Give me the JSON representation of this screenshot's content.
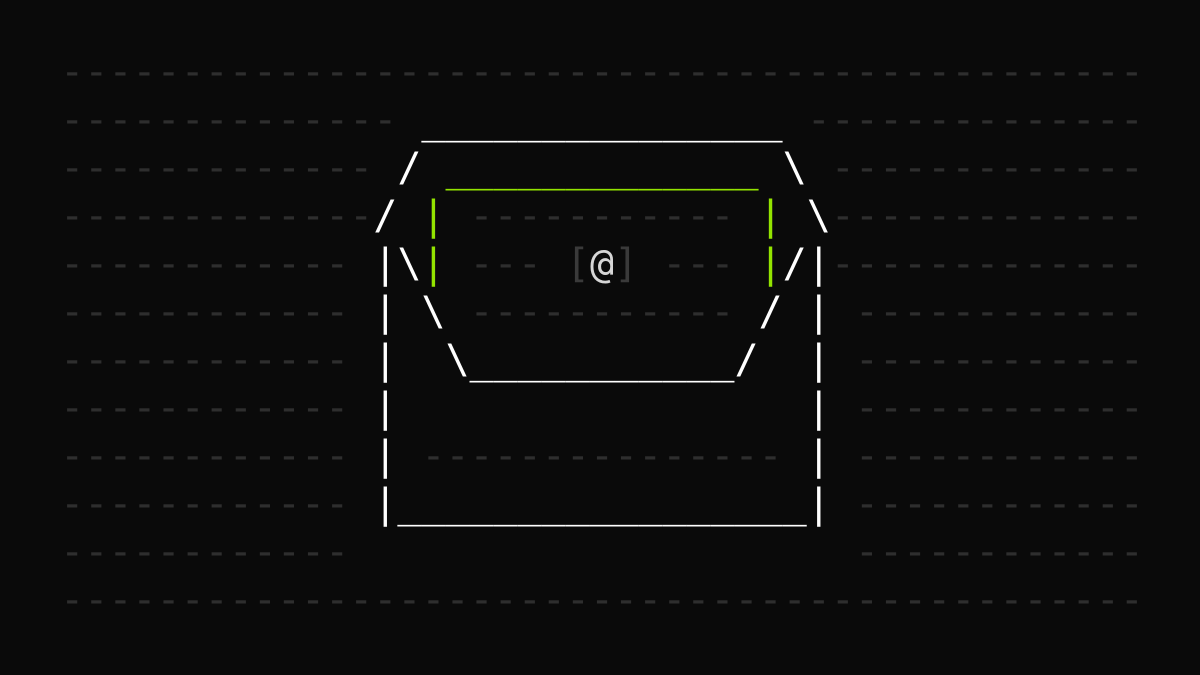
{
  "canvas": {
    "width_px": 1200,
    "height_px": 675,
    "background_color": "#0a0a0a"
  },
  "colors": {
    "background_dash_gray": "#2e2e2e",
    "envelope_white": "#ffffff",
    "letter_green": "#93e400",
    "bracket_gray": "#3a3a3a",
    "at_symbol_light": "#d6d6d6"
  },
  "ascii_art": {
    "background_dashes": [
      "",
      "  ---------------------------------------------",
      "  --------------                 --------------",
      "  -------------                   -------------",
      "  -------------    -----------    -------------",
      "  ------------     ---     ---    -------------",
      "  ------------     -----------     ------------",
      "  ------------                     ------------",
      "  ------------                     ------------",
      "  ------------   ---------------   ------------",
      "  ------------                     ------------",
      "  ------------                     ------------",
      "  ---------------------------------------------",
      ""
    ],
    "envelope_outline": [
      "",
      "",
      "                 _______________",
      "                /               \\",
      "               /                 \\",
      "               |\\               /|",
      "               | \\             / |",
      "               |  \\___________/  |",
      "               |                 |",
      "               |                 |",
      "               |_________________|",
      "",
      "",
      ""
    ],
    "letter_outline": [
      "",
      "",
      "",
      "                  _____________",
      "                 |             |",
      "                 |             |",
      "",
      "",
      "",
      "",
      "",
      "",
      "",
      ""
    ],
    "bracket_glyphs": [
      "",
      "",
      "",
      "",
      "",
      "                       [ ]",
      "",
      "",
      "",
      "",
      "",
      "",
      "",
      ""
    ],
    "at_glyph": [
      "",
      "",
      "",
      "",
      "",
      "                        @",
      "",
      "",
      "",
      "",
      "",
      "",
      "",
      ""
    ]
  }
}
